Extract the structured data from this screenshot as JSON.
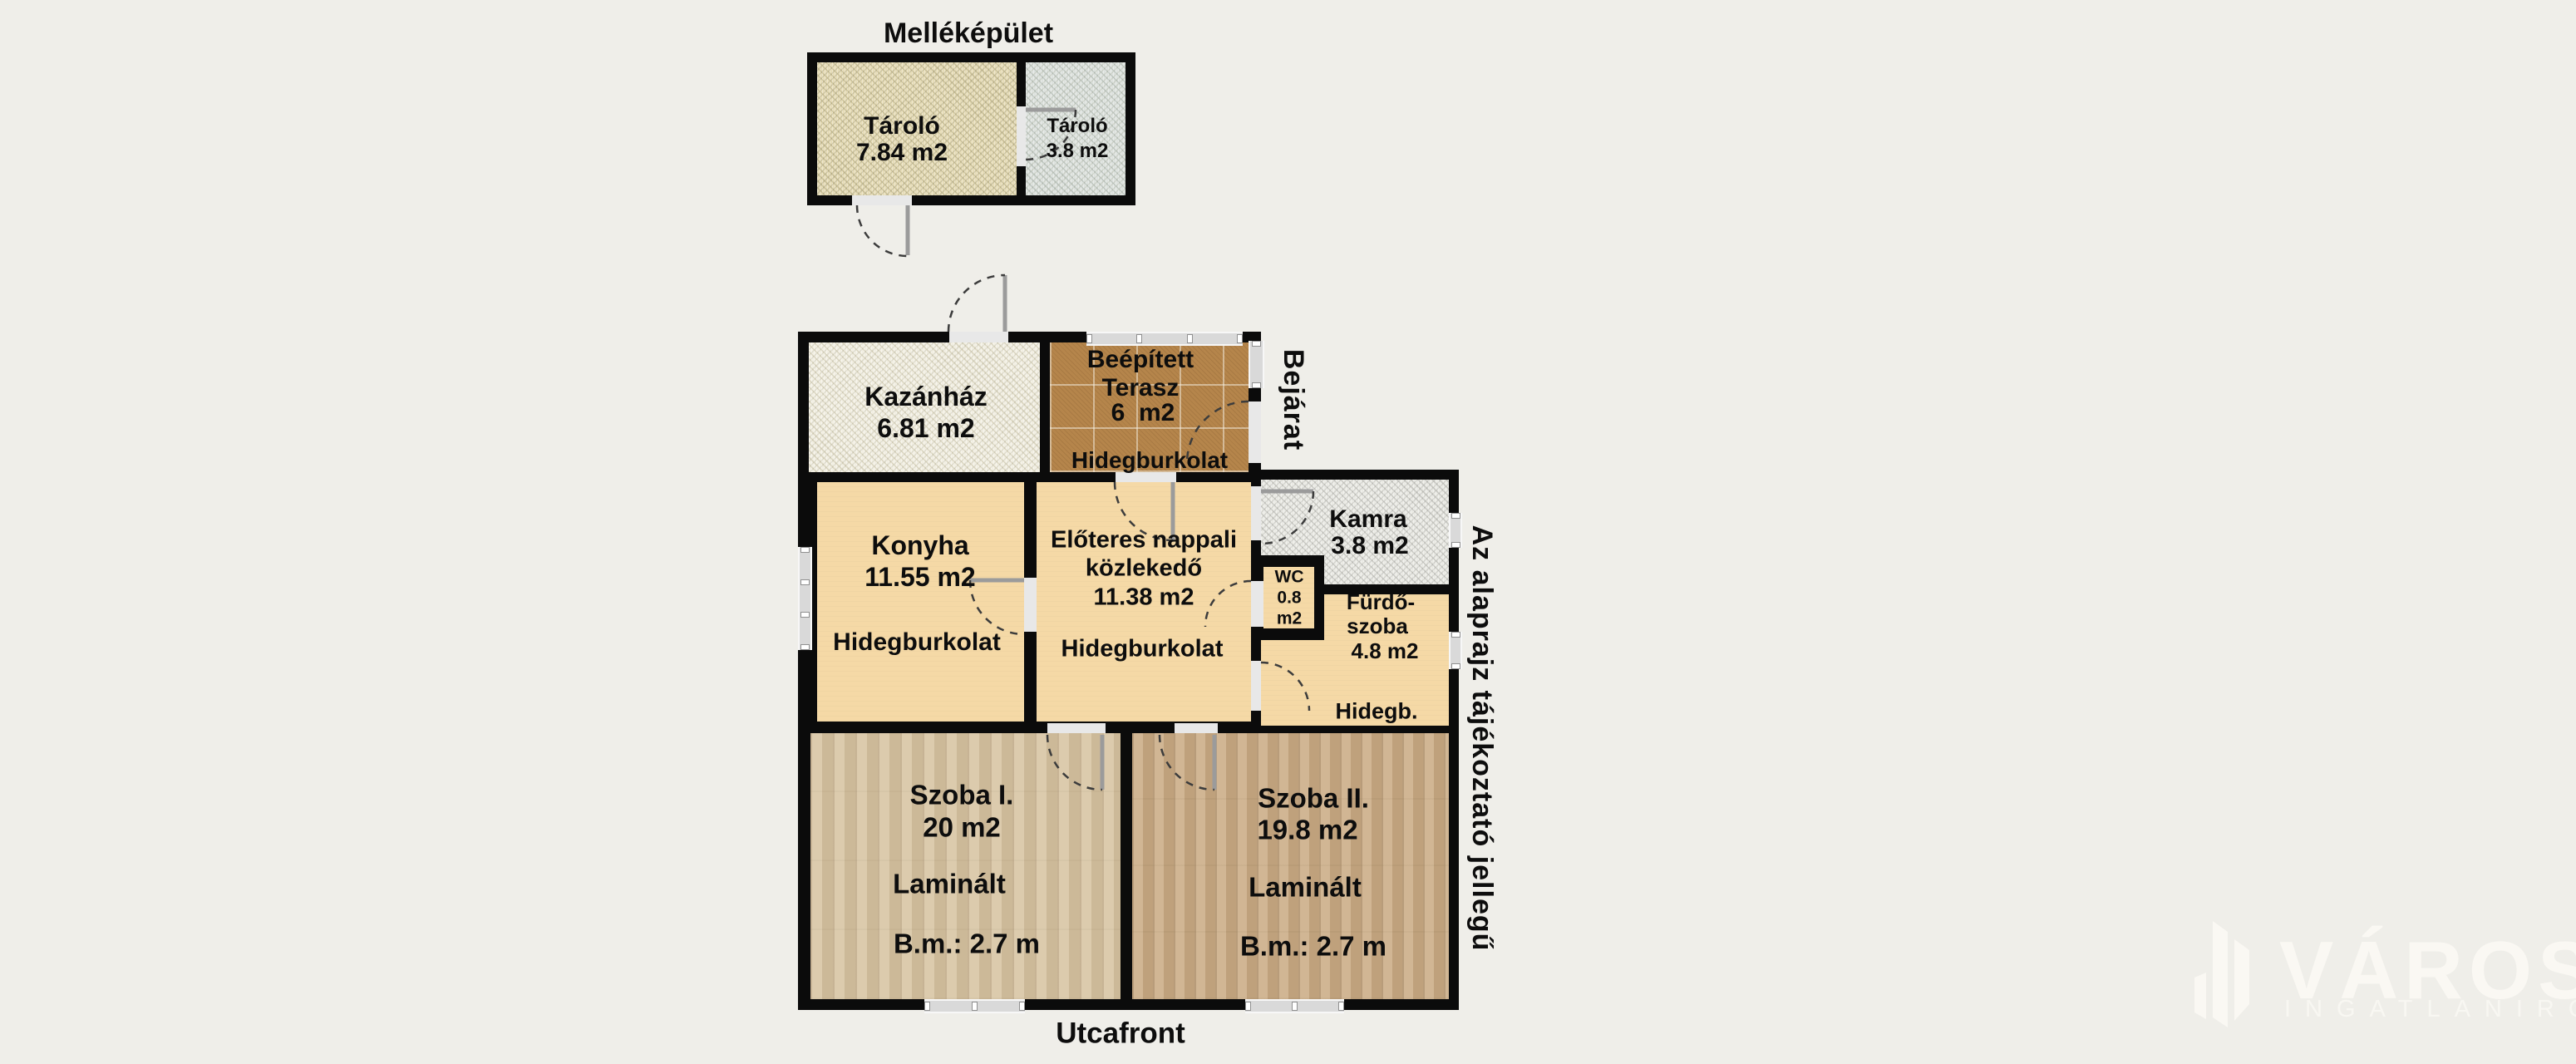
{
  "colors": {
    "bg": "#efeee9",
    "wall": "#0b0b0b",
    "sand": "#e7ddb8",
    "bluegrey": "#dde2de",
    "whitespeckle": "#f2efe2",
    "kamra_floor": "#eaeae4",
    "tile": "#b5854b",
    "tan": "#f5d9a6",
    "wood1": "#d8c5a4",
    "wood2": "#ccae88",
    "window": "#d9d9d9",
    "text": "#0d0d0d",
    "watermark": "#faf8f3"
  },
  "plan": {
    "outbuilding_title": "Melléképület",
    "entrance_label": "Bejárat",
    "street_label": "Utcafront",
    "disclaimer": "Az alaprajz tájékoztató jellegű",
    "rooms": {
      "tarolo_large": {
        "name": "Tároló",
        "area": "7.84 m2"
      },
      "tarolo_small": {
        "name": "Tároló",
        "area": "3.8 m2"
      },
      "kazanhaz": {
        "name": "Kazánház",
        "area": "6.81 m2"
      },
      "terasz": {
        "name_line1": "Beépített",
        "name_line2": "Terasz",
        "area": "6  m2",
        "flooring": "Hidegburkolat"
      },
      "konyha": {
        "name": "Konyha",
        "area": "11.55 m2",
        "flooring": "Hidegburkolat"
      },
      "nappali": {
        "name_line1": "Előteres nappali",
        "name_line2": "közlekedő",
        "area": "11.38 m2",
        "flooring": "Hidegburkolat"
      },
      "kamra": {
        "name": "Kamra",
        "area": "3.8 m2"
      },
      "wc": {
        "name": "WC",
        "area_value": "0.8",
        "area_unit": "m2"
      },
      "furdoszoba": {
        "name_line1": "Fürdő-",
        "name_line2": "szoba",
        "area": "4.8 m2",
        "flooring": "Hidegb."
      },
      "szoba1": {
        "name": "Szoba I.",
        "area": "20 m2",
        "flooring": "Laminált",
        "ceiling_height": "B.m.: 2.7 m"
      },
      "szoba2": {
        "name": "Szoba II.",
        "area": "19.8 m2",
        "flooring": "Laminált",
        "ceiling_height": "B.m.: 2.7 m"
      }
    }
  },
  "watermark": {
    "brand": "VÁROSI",
    "subtitle": "INGATLANIRODA"
  }
}
